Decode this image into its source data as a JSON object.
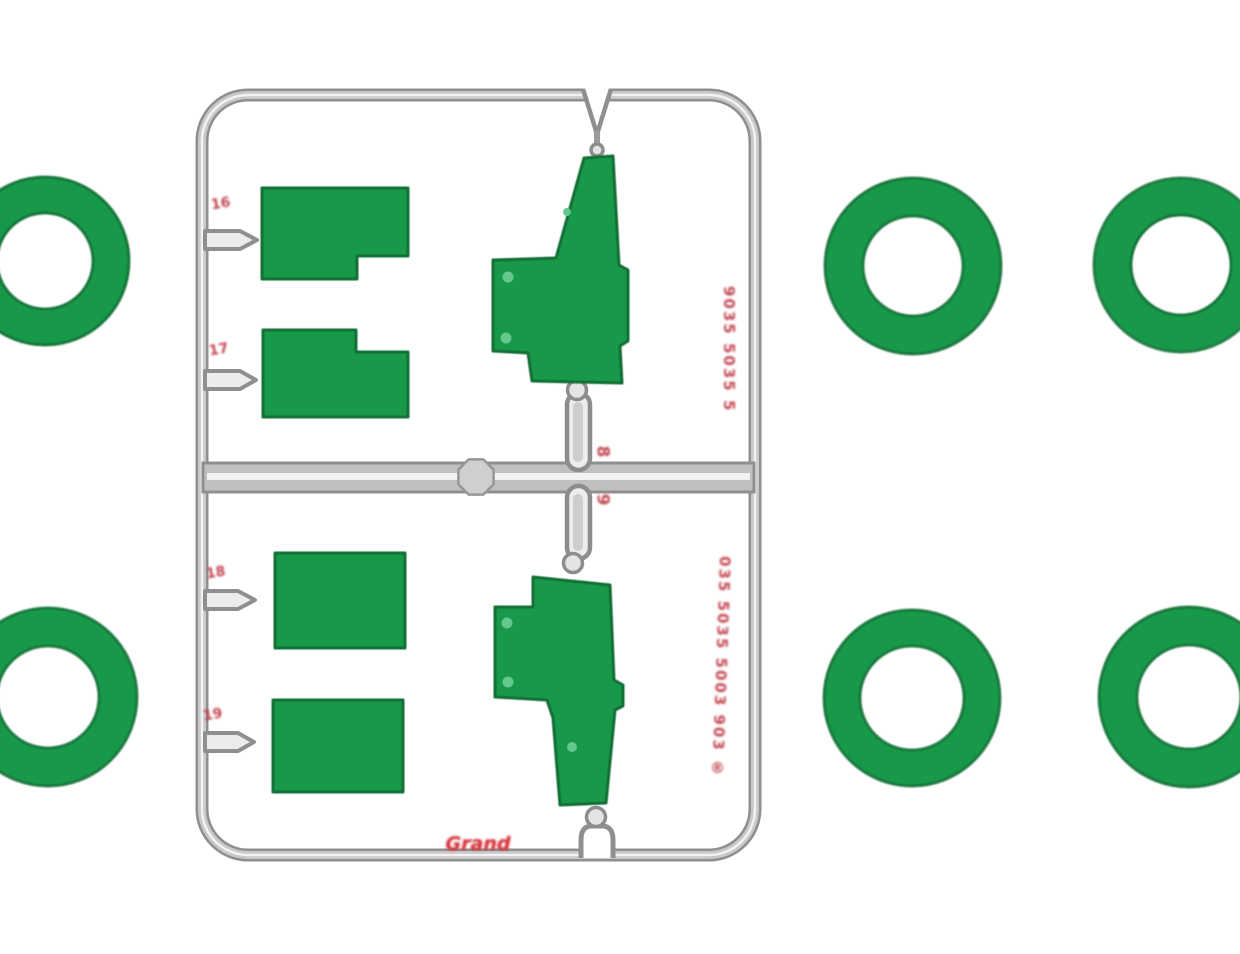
{
  "colors": {
    "background": "#ffffff",
    "part_green": "#18994a",
    "part_green_edge": "#116e35",
    "part_green_dot": "#63c78e",
    "runner_gray_edge": "#8f8f8f",
    "runner_gray_fill": "#c9c9c9",
    "runner_gray_highlight": "#f2f2f2",
    "marking_red": "#c2454f",
    "marking_red_bright": "#d6343c"
  },
  "markings": {
    "gate_labels": [
      "16",
      "17",
      "18",
      "19"
    ],
    "runner_labels": [
      "8",
      "9"
    ],
    "side_text_upper": "9035 5035 5",
    "side_text_lower": "035 5035 5003 903 ®",
    "brand_label": "Grand"
  }
}
